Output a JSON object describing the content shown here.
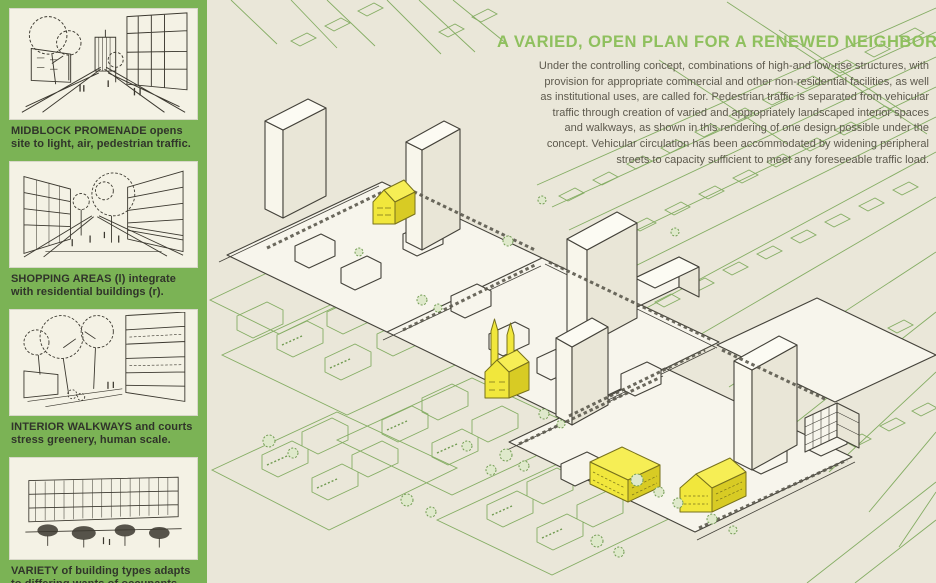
{
  "document": {
    "title": "A VARIED, OPEN PLAN FOR A RENEWED NEIGHBORHOOD",
    "intro": "Under the controlling concept, combinations of high-and low-rise structures, with provision for appropriate commercial and other non-residential facilities, as well as institutional uses, are called for. Pedestrian traffic is separated from vehicular traffic through creation of varied and appropriately landscaped interior spaces and walkways, as shown in this rendering of one design possible under the concept. Vehicular circulation has been accommodated by widening peripheral streets to capacity sufficient to meet any foreseeable traffic load."
  },
  "sidebar": {
    "figures": [
      {
        "caption": "MIDBLOCK PROMENADE opens site to light, air, pedestrian traffic."
      },
      {
        "caption": "SHOPPING AREAS (l) integrate with residential buildings (r)."
      },
      {
        "caption": "INTERIOR WALKWAYS and courts stress greenery, human scale."
      },
      {
        "caption": "VARIETY of building types adapts to differing wants of occupants."
      }
    ]
  },
  "colors": {
    "sidebar_green": "#7bb355",
    "title_green": "#8fc05e",
    "paper_cream": "#eae7d9",
    "highlight_yellow": "#f1e73c",
    "ink_black": "#44423a",
    "ink_green": "#85ad64",
    "body_text": "#5d594d"
  }
}
